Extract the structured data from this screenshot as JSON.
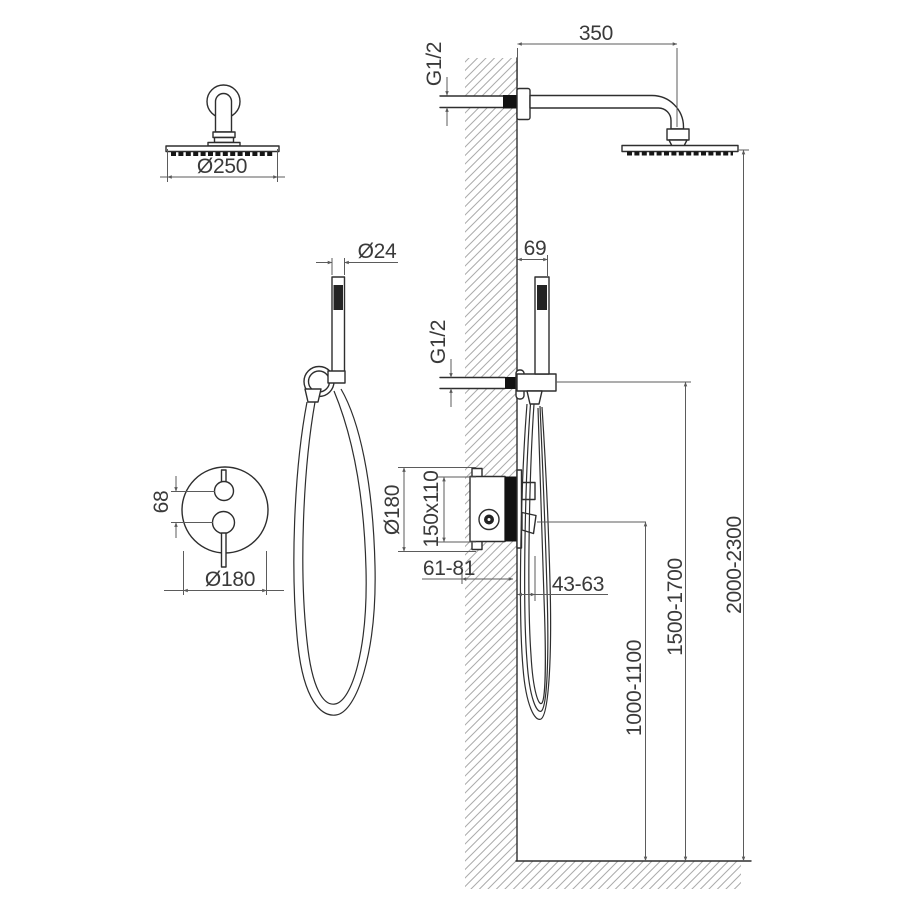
{
  "colors": {
    "background": "#ffffff",
    "object_line": "#2e2e2e",
    "dimension_line": "#5b5b5b",
    "text": "#3a3a3a",
    "hatch": "#ababab",
    "solid_fill": "#121212"
  },
  "dims": {
    "arm_length": "350",
    "arm_thread": "G1/2",
    "head_diameter": "Ø250",
    "hand_shower_diameter": "Ø24",
    "holder_offset": "69",
    "outlet_thread": "G1/2",
    "handle_spacing": "68",
    "trim_plate_diameter_front": "Ø180",
    "trim_plate_diameter_side": "Ø180",
    "rough_in_box": "150x110",
    "recess_depth": "61-81",
    "handle_projection": "43-63",
    "mixer_height": "1000-1100",
    "holder_height": "1500-1700",
    "head_height": "2000-2300"
  }
}
